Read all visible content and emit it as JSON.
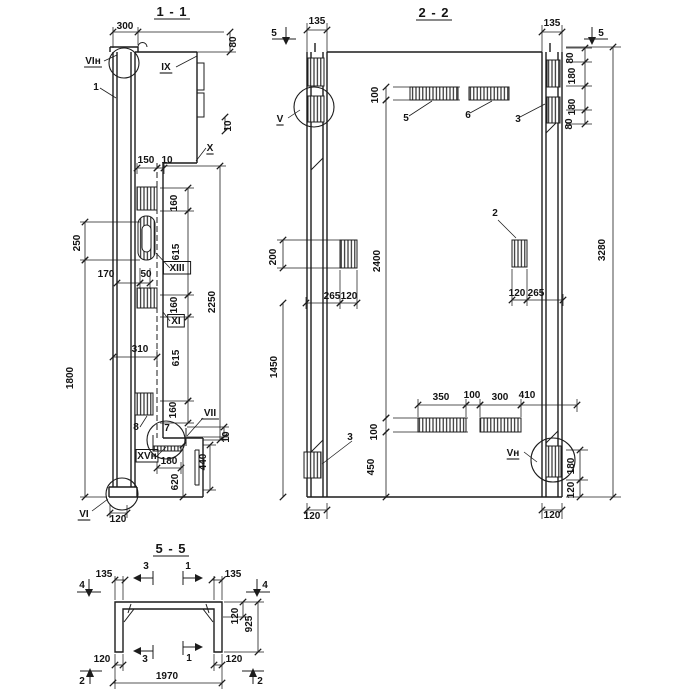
{
  "document": {
    "kind": "reinforced-panel shop drawing",
    "colors": {
      "ink": "#1c1c1c",
      "paper": "#ffffff"
    }
  },
  "sections": {
    "section_1_1": {
      "title": "1 - 1",
      "texts": [
        {
          "v": "1 - 1",
          "x": 172,
          "y": 16,
          "u": 1,
          "s": 1,
          "n": "section-1-1-title"
        },
        {
          "v": "300",
          "x": 125,
          "y": 29
        },
        {
          "v": "80",
          "x": 236,
          "y": 42,
          "r": 1
        },
        {
          "v": "VIн",
          "x": 93,
          "y": 64,
          "u": 1,
          "n": "ref-VIn"
        },
        {
          "v": "1",
          "x": 96,
          "y": 90,
          "n": "mark-1"
        },
        {
          "v": "IX",
          "x": 166,
          "y": 70,
          "u": 1,
          "n": "ref-IX"
        },
        {
          "v": "10",
          "x": 231,
          "y": 126,
          "r": 1
        },
        {
          "v": "X",
          "x": 210,
          "y": 151,
          "u": 1,
          "n": "ref-X"
        },
        {
          "v": "150",
          "x": 146,
          "y": 163
        },
        {
          "v": "10",
          "x": 167,
          "y": 163
        },
        {
          "v": "160",
          "x": 177,
          "y": 203,
          "r": 1
        },
        {
          "v": "615",
          "x": 179,
          "y": 252,
          "r": 1
        },
        {
          "v": "XIII",
          "x": 177,
          "y": 271,
          "b": 1,
          "n": "ref-XIII"
        },
        {
          "v": "160",
          "x": 177,
          "y": 305,
          "r": 1
        },
        {
          "v": "XI",
          "x": 176,
          "y": 324,
          "b": 1,
          "n": "ref-XI"
        },
        {
          "v": "615",
          "x": 179,
          "y": 358,
          "r": 1
        },
        {
          "v": "160",
          "x": 176,
          "y": 410,
          "r": 1
        },
        {
          "v": "2250",
          "x": 215,
          "y": 302,
          "r": 1
        },
        {
          "v": "250",
          "x": 80,
          "y": 243,
          "r": 1
        },
        {
          "v": "1800",
          "x": 73,
          "y": 378,
          "r": 1
        },
        {
          "v": "170",
          "x": 106,
          "y": 277
        },
        {
          "v": "50",
          "x": 146,
          "y": 277
        },
        {
          "v": "310",
          "x": 140,
          "y": 352
        },
        {
          "v": "8",
          "x": 136,
          "y": 430,
          "n": "mark-8"
        },
        {
          "v": "7",
          "x": 167,
          "y": 431,
          "n": "mark-7"
        },
        {
          "v": "VII",
          "x": 210,
          "y": 416,
          "u": 1,
          "n": "ref-VII"
        },
        {
          "v": "XVн",
          "x": 147,
          "y": 459,
          "b": 1,
          "n": "ref-XVn"
        },
        {
          "v": "180",
          "x": 169,
          "y": 464
        },
        {
          "v": "620",
          "x": 178,
          "y": 482,
          "r": 1
        },
        {
          "v": "440",
          "x": 206,
          "y": 462,
          "r": 1
        },
        {
          "v": "10",
          "x": 229,
          "y": 437,
          "r": 1
        },
        {
          "v": "VI",
          "x": 84,
          "y": 517,
          "u": 1,
          "n": "ref-VI"
        },
        {
          "v": "120",
          "x": 118,
          "y": 522
        }
      ],
      "dims": [
        [
          113,
          32,
          138,
          32
        ],
        [
          230,
          32,
          230,
          52
        ],
        [
          137,
          168,
          157,
          168
        ],
        [
          157,
          168,
          164,
          168
        ],
        [
          188,
          188,
          188,
          211
        ],
        [
          188,
          211,
          188,
          295
        ],
        [
          188,
          295,
          188,
          317
        ],
        [
          188,
          317,
          188,
          401
        ],
        [
          188,
          401,
          188,
          423
        ],
        [
          220,
          166,
          220,
          440
        ],
        [
          85,
          222,
          85,
          260
        ],
        [
          85,
          260,
          85,
          497
        ],
        [
          117,
          283,
          140,
          283
        ],
        [
          140,
          283,
          150,
          283
        ],
        [
          113,
          357,
          157,
          357
        ],
        [
          157,
          468,
          181,
          468
        ],
        [
          183,
          445,
          183,
          497
        ],
        [
          210,
          445,
          210,
          490
        ],
        [
          224,
          427,
          224,
          437
        ],
        [
          110,
          513,
          127,
          513
        ],
        [
          225,
          117,
          225,
          131
        ]
      ]
    },
    "section_2_2": {
      "title": "2 - 2",
      "texts": [
        {
          "v": "2 - 2",
          "x": 434,
          "y": 17,
          "u": 1,
          "s": 1,
          "n": "section-2-2-title"
        },
        {
          "v": "5",
          "x": 274,
          "y": 36,
          "n": "cut-mark-5"
        },
        {
          "v": "135",
          "x": 317,
          "y": 24
        },
        {
          "v": "135",
          "x": 552,
          "y": 26
        },
        {
          "v": "5",
          "x": 601,
          "y": 36,
          "n": "cut-mark-5"
        },
        {
          "v": "80",
          "x": 573,
          "y": 58,
          "r": 1
        },
        {
          "v": "180",
          "x": 575,
          "y": 76,
          "r": 1
        },
        {
          "v": "180",
          "x": 575,
          "y": 107,
          "r": 1
        },
        {
          "v": "80",
          "x": 572,
          "y": 124,
          "r": 1
        },
        {
          "v": "3280",
          "x": 605,
          "y": 250,
          "r": 1
        },
        {
          "v": "V",
          "x": 280,
          "y": 122,
          "u": 1,
          "n": "ref-V"
        },
        {
          "v": "100",
          "x": 378,
          "y": 95,
          "r": 1
        },
        {
          "v": "5",
          "x": 406,
          "y": 121,
          "n": "mark-5"
        },
        {
          "v": "6",
          "x": 468,
          "y": 118,
          "n": "mark-6"
        },
        {
          "v": "3",
          "x": 518,
          "y": 122,
          "n": "mark-3"
        },
        {
          "v": "2",
          "x": 495,
          "y": 216,
          "n": "mark-2"
        },
        {
          "v": "2400",
          "x": 380,
          "y": 261,
          "r": 1
        },
        {
          "v": "200",
          "x": 276,
          "y": 257,
          "r": 1
        },
        {
          "v": "265",
          "x": 332,
          "y": 299
        },
        {
          "v": "120",
          "x": 349,
          "y": 299
        },
        {
          "v": "120",
          "x": 517,
          "y": 296
        },
        {
          "v": "265",
          "x": 536,
          "y": 296
        },
        {
          "v": "1450",
          "x": 277,
          "y": 367,
          "r": 1
        },
        {
          "v": "350",
          "x": 441,
          "y": 400
        },
        {
          "v": "100",
          "x": 472,
          "y": 398
        },
        {
          "v": "300",
          "x": 500,
          "y": 400
        },
        {
          "v": "410",
          "x": 527,
          "y": 398
        },
        {
          "v": "100",
          "x": 377,
          "y": 432,
          "r": 1
        },
        {
          "v": "450",
          "x": 374,
          "y": 467,
          "r": 1
        },
        {
          "v": "3",
          "x": 350,
          "y": 440,
          "n": "mark-3"
        },
        {
          "v": "Vн",
          "x": 513,
          "y": 456,
          "u": 1,
          "n": "ref-Vn"
        },
        {
          "v": "180",
          "x": 574,
          "y": 466,
          "r": 1
        },
        {
          "v": "120",
          "x": 574,
          "y": 490,
          "r": 1
        },
        {
          "v": "120",
          "x": 312,
          "y": 519
        },
        {
          "v": "120",
          "x": 552,
          "y": 518
        }
      ],
      "dims": [
        [
          307,
          30,
          327,
          30
        ],
        [
          542,
          32,
          562,
          32
        ],
        [
          585,
          48,
          585,
          62
        ],
        [
          585,
          62,
          585,
          86
        ],
        [
          585,
          86,
          585,
          110
        ],
        [
          585,
          110,
          585,
          124
        ],
        [
          613,
          47,
          613,
          497
        ],
        [
          386,
          87,
          386,
          100
        ],
        [
          386,
          100,
          386,
          418
        ],
        [
          386,
          418,
          386,
          432
        ],
        [
          386,
          432,
          386,
          497
        ],
        [
          283,
          240,
          283,
          268
        ],
        [
          283,
          303,
          283,
          497
        ],
        [
          306,
          303,
          340,
          303
        ],
        [
          340,
          303,
          357,
          303
        ],
        [
          512,
          300,
          527,
          300
        ],
        [
          527,
          300,
          563,
          300
        ],
        [
          418,
          405,
          466,
          405
        ],
        [
          466,
          405,
          480,
          405
        ],
        [
          480,
          405,
          521,
          405
        ],
        [
          521,
          405,
          577,
          405
        ],
        [
          580,
          450,
          580,
          480
        ],
        [
          580,
          480,
          580,
          497
        ],
        [
          307,
          510,
          327,
          510
        ],
        [
          542,
          510,
          562,
          510
        ]
      ]
    },
    "section_5_5": {
      "title": "5 - 5",
      "texts": [
        {
          "v": "5 - 5",
          "x": 171,
          "y": 553,
          "u": 1,
          "s": 1,
          "n": "section-5-5-title"
        },
        {
          "v": "4",
          "x": 82,
          "y": 588,
          "n": "cut-mark-4"
        },
        {
          "v": "135",
          "x": 104,
          "y": 577
        },
        {
          "v": "3",
          "x": 146,
          "y": 569,
          "n": "cut-mark-3"
        },
        {
          "v": "1",
          "x": 188,
          "y": 569,
          "n": "cut-mark-1"
        },
        {
          "v": "135",
          "x": 233,
          "y": 577
        },
        {
          "v": "4",
          "x": 265,
          "y": 588,
          "n": "cut-mark-4"
        },
        {
          "v": "120",
          "x": 238,
          "y": 616,
          "r": 1
        },
        {
          "v": "925",
          "x": 252,
          "y": 624,
          "r": 1
        },
        {
          "v": "120",
          "x": 102,
          "y": 662
        },
        {
          "v": "3",
          "x": 145,
          "y": 662,
          "n": "cut-mark-3"
        },
        {
          "v": "1",
          "x": 189,
          "y": 661,
          "n": "cut-mark-1"
        },
        {
          "v": "120",
          "x": 234,
          "y": 662
        },
        {
          "v": "1970",
          "x": 167,
          "y": 679
        },
        {
          "v": "2",
          "x": 82,
          "y": 684,
          "n": "cut-mark-2"
        },
        {
          "v": "2",
          "x": 260,
          "y": 684,
          "n": "cut-mark-2"
        }
      ],
      "dims": [
        [
          115,
          580,
          125,
          580
        ],
        [
          212,
          580,
          222,
          580
        ],
        [
          243,
          602,
          243,
          617
        ],
        [
          258,
          602,
          258,
          652
        ],
        [
          115,
          665,
          123,
          665
        ],
        [
          214,
          665,
          222,
          665
        ],
        [
          113,
          683,
          222,
          683
        ]
      ]
    }
  }
}
